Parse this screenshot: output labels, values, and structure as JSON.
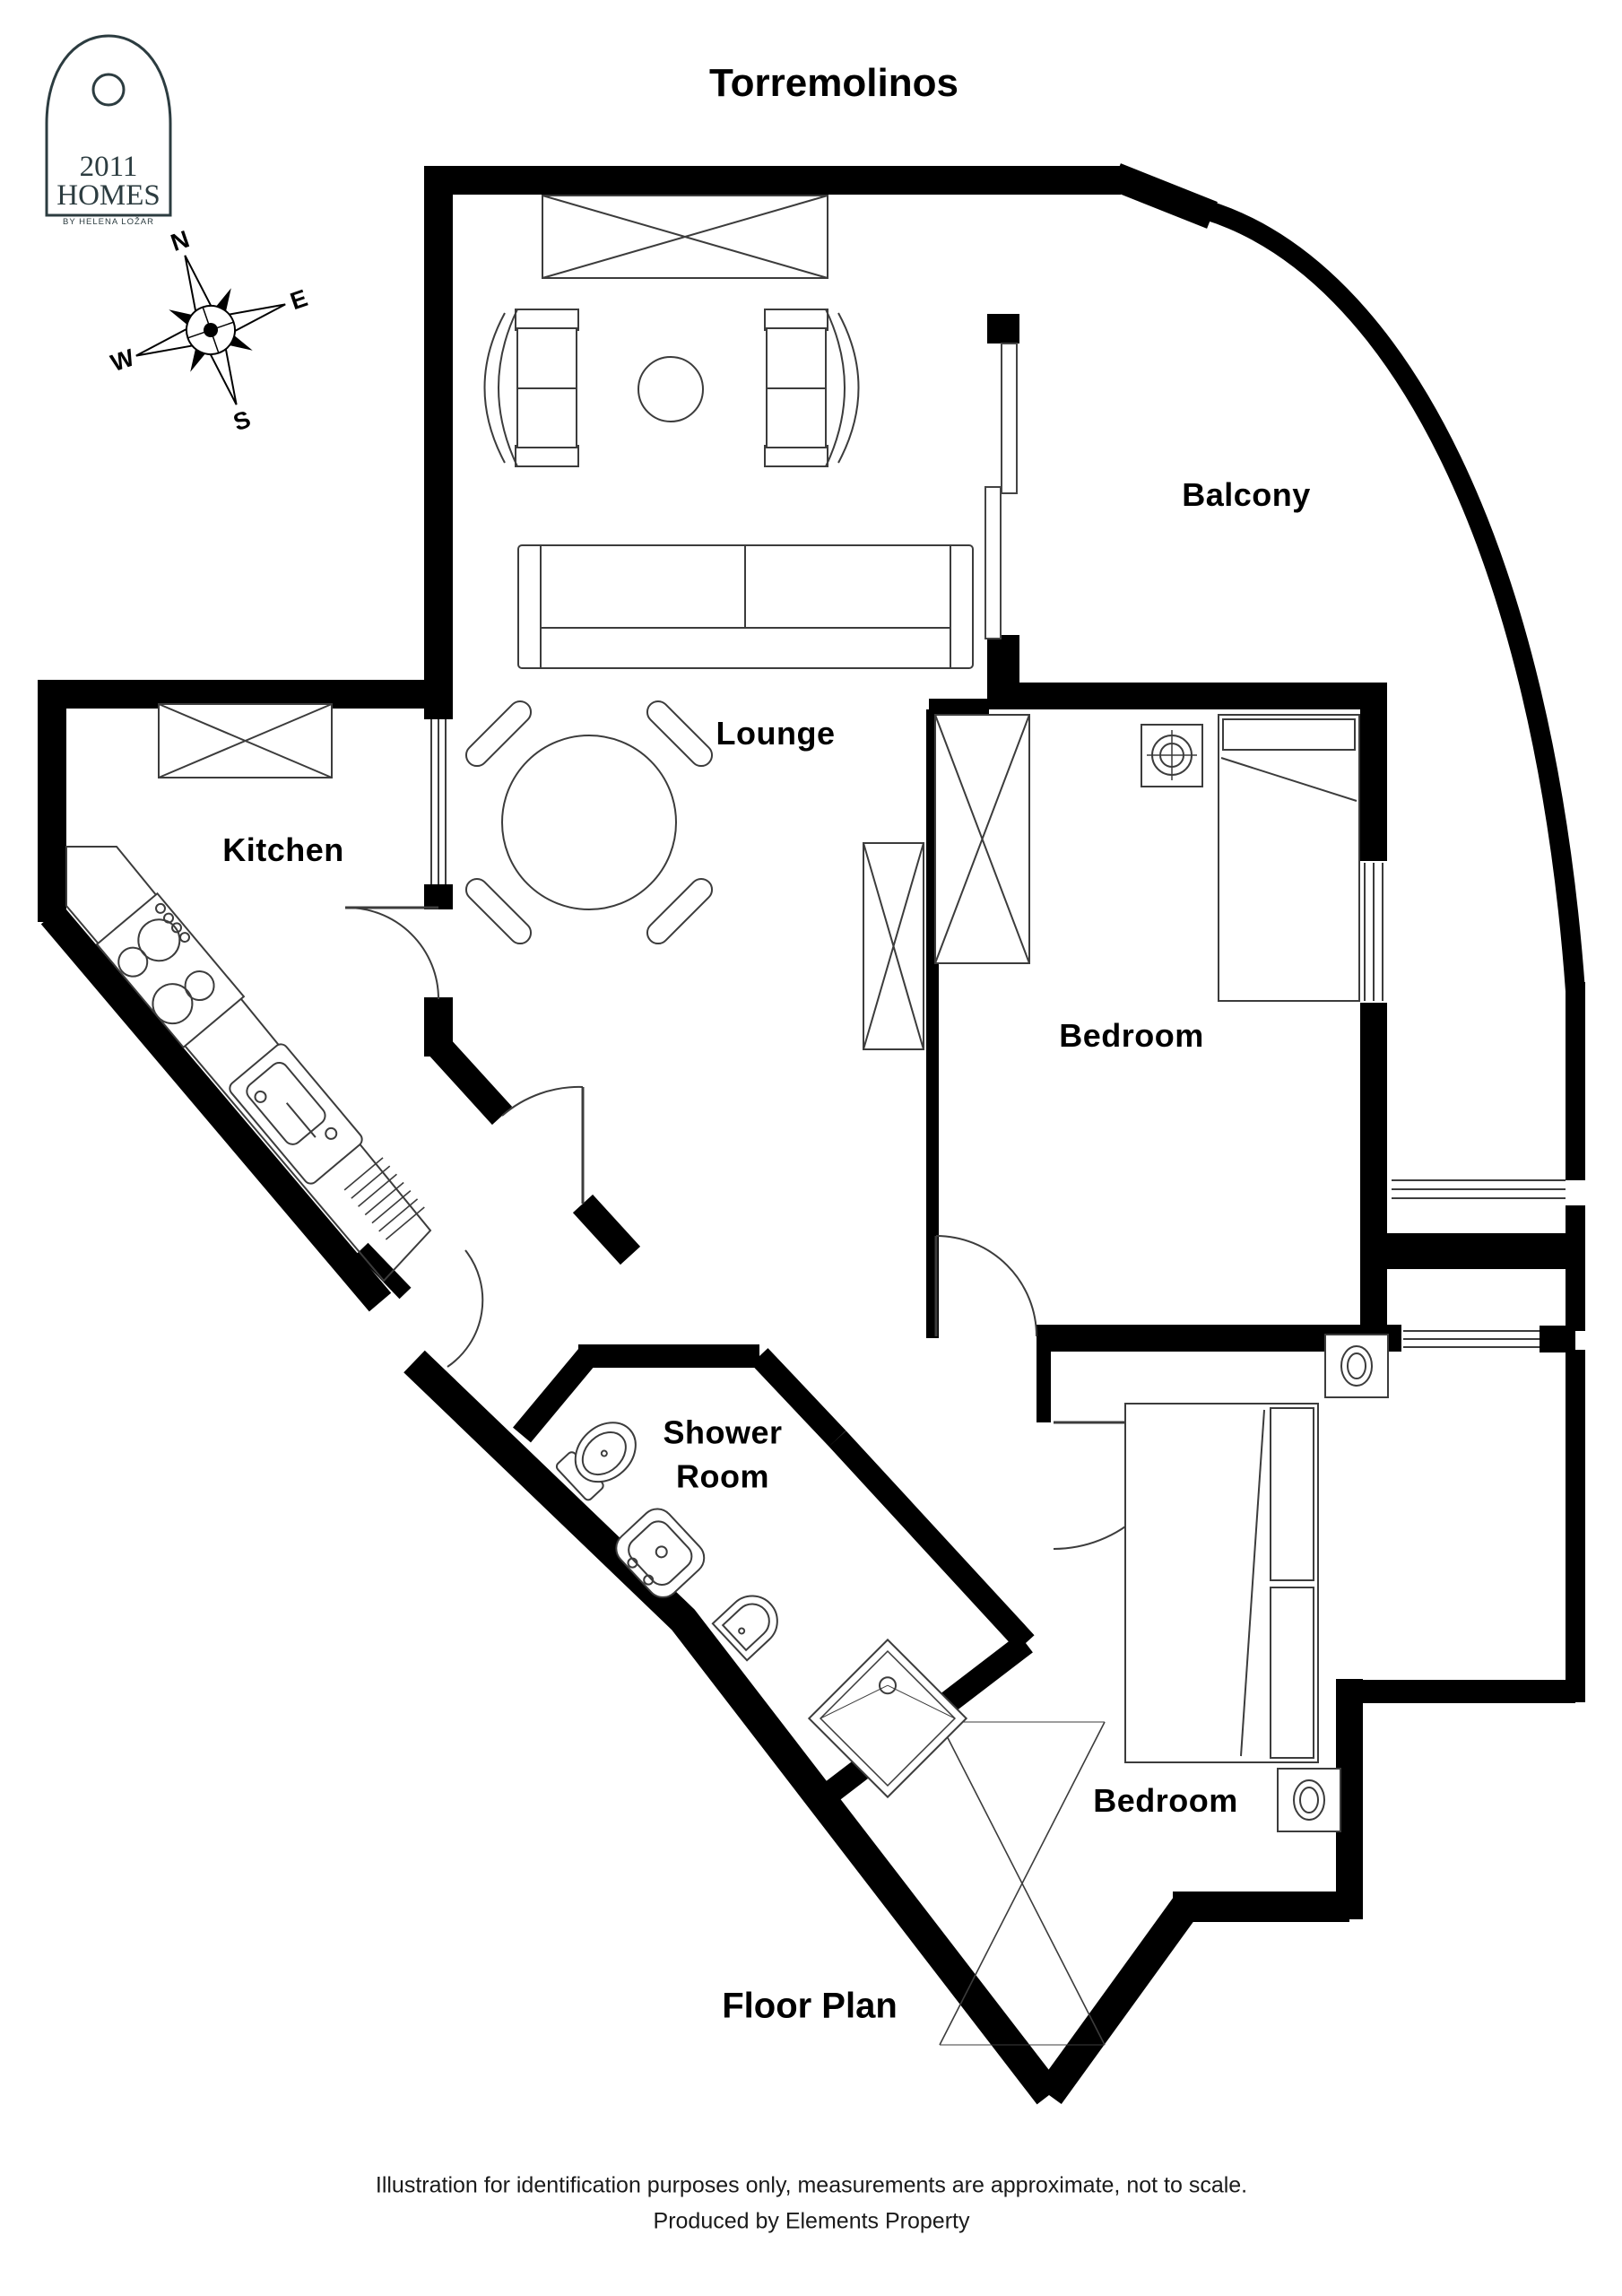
{
  "title": "Torremolinos",
  "caption": "Floor Plan",
  "logo": {
    "year": "2011",
    "name": "HOMES",
    "byline": "BY HELENA LOŽAR"
  },
  "compass": {
    "n": "N",
    "e": "E",
    "s": "S",
    "w": "W"
  },
  "rooms": {
    "balcony": "Balcony",
    "lounge": "Lounge",
    "kitchen": "Kitchen",
    "bedroom1": "Bedroom",
    "bedroom2": "Bedroom",
    "shower_line1": "Shower",
    "shower_line2": "Room"
  },
  "footer": {
    "line1": "Illustration for identification purposes only, measurements are approximate, not to scale.",
    "line2": "Produced by Elements Property"
  },
  "colors": {
    "walls": "#000000",
    "paper": "#ffffff",
    "furniture_line": "#3c3c3c",
    "logo_ink": "#2c3c40"
  }
}
